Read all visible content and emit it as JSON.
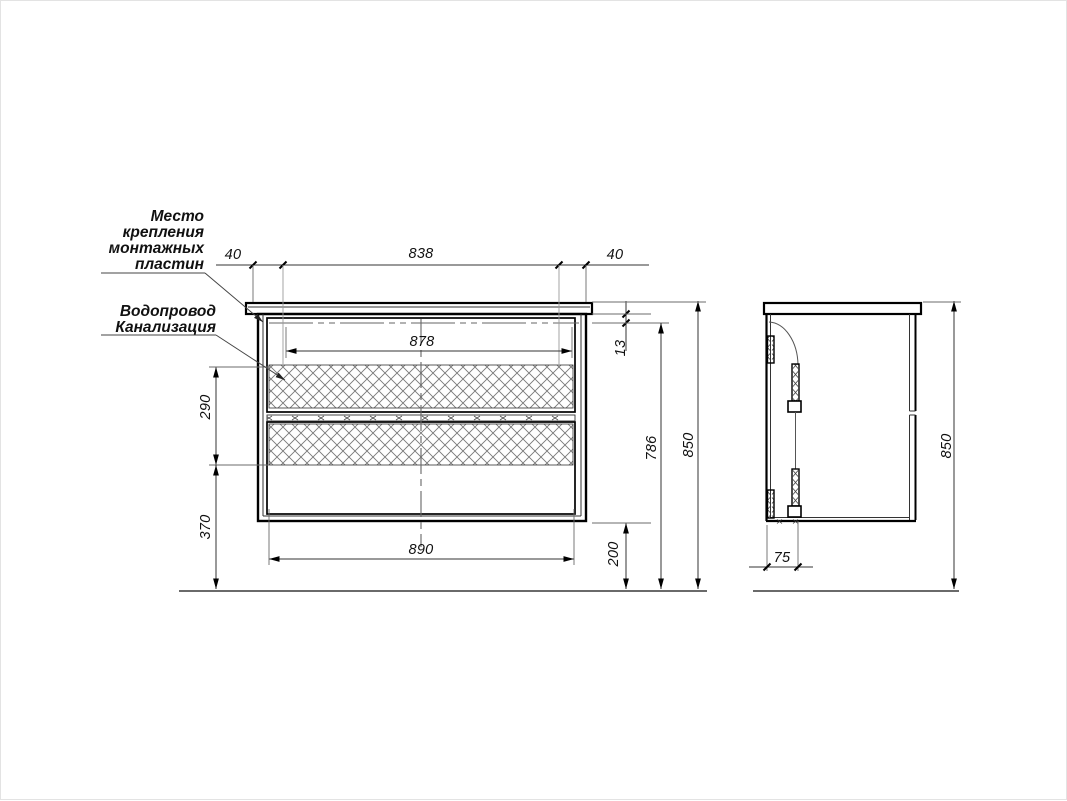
{
  "drawing": {
    "type": "vanity-cabinet-technical-drawing",
    "labels": {
      "mounting_plates_lines": [
        "Место",
        "крепления",
        "монтажных",
        "пластин"
      ],
      "plumbing_lines": [
        "Водопровод",
        "Канализация"
      ]
    },
    "front_view": {
      "dim_top_left": "40",
      "dim_top_center": "838",
      "dim_top_right": "40",
      "dim_inner_width": "878",
      "dim_plate_offset": "13",
      "dim_service_zone_height": "290",
      "dim_lower_zone_height": "370",
      "dim_cabinet_width": "890",
      "dim_floor_clearance": "200",
      "dim_mount_line_height": "786",
      "dim_total_height": "850"
    },
    "side_view": {
      "dim_bracket_depth": "75",
      "dim_total_height": "850"
    }
  }
}
